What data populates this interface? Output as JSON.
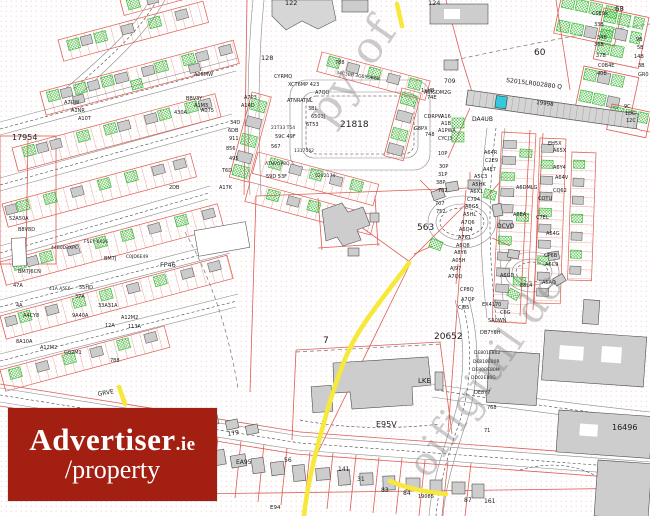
{
  "logo": {
    "brand": "Advertiser",
    "tld": ".ie",
    "line2": "/property",
    "bg_color": "#a31f12",
    "fg_color": "#ffffff"
  },
  "map": {
    "highlight_reference": "S2015LR002880 Q",
    "colors": {
      "parcel_red": "#dd5d52",
      "building_gray": "#cdcdcd",
      "green_hatch": "#2eb82e",
      "route_yellow": "#f6e93c",
      "highlight_cyan": "#35c8dc",
      "stipple_pink": "#f0b8b8"
    },
    "watermarks": [
      {
        "t": "py of",
        "x": 330,
        "y": 128,
        "s": 44,
        "r": -55
      },
      {
        "t": "oifigiúil de",
        "x": 428,
        "y": 480,
        "s": 40,
        "r": -55
      }
    ],
    "labels": [
      {
        "t": "17954",
        "x": 12,
        "y": 140,
        "s": 8
      },
      {
        "t": "21818",
        "x": 340,
        "y": 127,
        "s": 9
      },
      {
        "t": "563",
        "x": 417,
        "y": 230,
        "s": 9
      },
      {
        "t": "7",
        "x": 323,
        "y": 343,
        "s": 9
      },
      {
        "t": "20652",
        "x": 434,
        "y": 339,
        "s": 9
      },
      {
        "t": "E95V",
        "x": 376,
        "y": 427,
        "s": 8
      },
      {
        "t": "60",
        "x": 534,
        "y": 55,
        "s": 9
      },
      {
        "t": "68",
        "x": 615,
        "y": 11,
        "s": 7
      },
      {
        "t": "16496",
        "x": 612,
        "y": 430,
        "s": 8
      },
      {
        "t": "122",
        "x": 285,
        "y": 5,
        "s": 6.5
      },
      {
        "t": "124",
        "x": 428,
        "y": 5,
        "s": 6.5
      },
      {
        "t": "128",
        "x": 261,
        "y": 60,
        "s": 6.5
      },
      {
        "t": "FF46",
        "x": 160,
        "y": 267,
        "s": 6.5
      },
      {
        "t": "LKE",
        "x": 418,
        "y": 383,
        "s": 7
      },
      {
        "t": "GRVE",
        "x": 98,
        "y": 396,
        "s": 6,
        "r": -10
      },
      {
        "t": "DA4UB",
        "x": 472,
        "y": 121,
        "s": 6
      },
      {
        "t": "709",
        "x": 444,
        "y": 83,
        "s": 6
      },
      {
        "t": "A6IGDM2G",
        "x": 424,
        "y": 94,
        "s": 5
      },
      {
        "t": "S2015LR002880 Q",
        "x": 506,
        "y": 82,
        "s": 6,
        "r": 7
      },
      {
        "t": "19998",
        "x": 536,
        "y": 104,
        "s": 5.5,
        "r": 7
      },
      {
        "t": "DCVD",
        "x": 497,
        "y": 228,
        "s": 6
      },
      {
        "t": "0024",
        "x": 204,
        "y": 430,
        "s": 5.5,
        "r": -10
      },
      {
        "t": "179",
        "x": 228,
        "y": 436,
        "s": 6,
        "r": -10
      },
      {
        "t": "EA95",
        "x": 236,
        "y": 464,
        "s": 6
      },
      {
        "t": "56",
        "x": 284,
        "y": 462,
        "s": 6
      },
      {
        "t": "141",
        "x": 338,
        "y": 471,
        "s": 6
      },
      {
        "t": "31",
        "x": 357,
        "y": 481,
        "s": 6
      },
      {
        "t": "83",
        "x": 381,
        "y": 492,
        "s": 6
      },
      {
        "t": "84",
        "x": 403,
        "y": 495,
        "s": 6
      },
      {
        "t": "19085",
        "x": 418,
        "y": 498,
        "s": 5
      },
      {
        "t": "87",
        "x": 464,
        "y": 502,
        "s": 6
      },
      {
        "t": "161",
        "x": 484,
        "y": 503,
        "s": 6
      },
      {
        "t": "E94",
        "x": 270,
        "y": 509,
        "s": 5.5
      },
      {
        "t": "A16",
        "x": 441,
        "y": 118,
        "s": 5
      },
      {
        "t": "A1B",
        "x": 441,
        "y": 125,
        "s": 5
      },
      {
        "t": "A1PWA",
        "x": 438,
        "y": 132,
        "s": 5
      },
      {
        "t": "CYCJ3",
        "x": 438,
        "y": 140,
        "s": 5
      },
      {
        "t": "10P",
        "x": 438,
        "y": 155,
        "s": 5
      },
      {
        "t": "30P",
        "x": 439,
        "y": 168,
        "s": 5
      },
      {
        "t": "31P",
        "x": 438,
        "y": 176,
        "s": 5
      },
      {
        "t": "38P",
        "x": 436,
        "y": 184,
        "s": 5
      },
      {
        "t": "702",
        "x": 438,
        "y": 192,
        "s": 5
      },
      {
        "t": "707",
        "x": 435,
        "y": 205,
        "s": 5
      },
      {
        "t": "752",
        "x": 436,
        "y": 213,
        "s": 5
      },
      {
        "t": "A64R",
        "x": 484,
        "y": 154,
        "s": 5
      },
      {
        "t": "C2E9",
        "x": 485,
        "y": 162,
        "s": 5
      },
      {
        "t": "A4E7",
        "x": 483,
        "y": 171,
        "s": 5
      },
      {
        "t": "A5C3",
        "x": 474,
        "y": 178,
        "s": 5
      },
      {
        "t": "A5HK",
        "x": 472,
        "y": 186,
        "s": 5
      },
      {
        "t": "A6X1",
        "x": 470,
        "y": 193,
        "s": 5
      },
      {
        "t": "C794",
        "x": 467,
        "y": 201,
        "s": 5
      },
      {
        "t": "A6G5",
        "x": 465,
        "y": 208,
        "s": 5
      },
      {
        "t": "A5HL",
        "x": 463,
        "y": 216,
        "s": 5
      },
      {
        "t": "A7Q6",
        "x": 461,
        "y": 224,
        "s": 5
      },
      {
        "t": "A6Q4",
        "x": 459,
        "y": 231,
        "s": 5
      },
      {
        "t": "A761",
        "x": 458,
        "y": 239,
        "s": 5
      },
      {
        "t": "A6Q8",
        "x": 456,
        "y": 247,
        "s": 5
      },
      {
        "t": "A8Y6",
        "x": 454,
        "y": 254,
        "s": 5
      },
      {
        "t": "A05H",
        "x": 452,
        "y": 262,
        "s": 5
      },
      {
        "t": "AJ97",
        "x": 450,
        "y": 270,
        "s": 5
      },
      {
        "t": "A7QQ",
        "x": 448,
        "y": 278,
        "s": 5
      },
      {
        "t": "CP8Q",
        "x": 460,
        "y": 291,
        "s": 5
      },
      {
        "t": "A7QP",
        "x": 461,
        "y": 301,
        "s": 5
      },
      {
        "t": "CJ85",
        "x": 458,
        "y": 309,
        "s": 5
      },
      {
        "t": "EX4170",
        "x": 482,
        "y": 306,
        "s": 5
      },
      {
        "t": "C6G",
        "x": 500,
        "y": 314,
        "s": 5
      },
      {
        "t": "SA0WN",
        "x": 488,
        "y": 322,
        "s": 5
      },
      {
        "t": "DB7Y6H",
        "x": 480,
        "y": 334,
        "s": 5
      },
      {
        "t": "DE801E802",
        "x": 474,
        "y": 354,
        "s": 4.5
      },
      {
        "t": "DE810E80R",
        "x": 473,
        "y": 363,
        "s": 4.5
      },
      {
        "t": "DE80BE80M",
        "x": 472,
        "y": 371,
        "s": 4.5
      },
      {
        "t": "DD02E80G",
        "x": 471,
        "y": 379,
        "s": 4.5
      },
      {
        "t": "DE8Y7",
        "x": 474,
        "y": 394,
        "s": 5
      },
      {
        "t": "768",
        "x": 487,
        "y": 409,
        "s": 5
      },
      {
        "t": "71",
        "x": 484,
        "y": 432,
        "s": 5
      },
      {
        "t": "EH5X",
        "x": 548,
        "y": 145,
        "s": 5
      },
      {
        "t": "A65X",
        "x": 553,
        "y": 152,
        "s": 5
      },
      {
        "t": "A6Y4",
        "x": 553,
        "y": 169,
        "s": 5
      },
      {
        "t": "A64V",
        "x": 555,
        "y": 179,
        "s": 5
      },
      {
        "t": "A6DMLG",
        "x": 516,
        "y": 189,
        "s": 5
      },
      {
        "t": "CQ62",
        "x": 553,
        "y": 192,
        "s": 5
      },
      {
        "t": "CQTU",
        "x": 538,
        "y": 200,
        "s": 5
      },
      {
        "t": "A6EA",
        "x": 513,
        "y": 216,
        "s": 5
      },
      {
        "t": "C7EL",
        "x": 536,
        "y": 219,
        "s": 5
      },
      {
        "t": "A64G",
        "x": 546,
        "y": 235,
        "s": 5
      },
      {
        "t": "CP6B",
        "x": 544,
        "y": 257,
        "s": 5
      },
      {
        "t": "A6C9",
        "x": 545,
        "y": 266,
        "s": 5
      },
      {
        "t": "A6GD",
        "x": 500,
        "y": 277,
        "s": 5
      },
      {
        "t": "E8L4",
        "x": 520,
        "y": 287,
        "s": 5
      },
      {
        "t": "A6AQ",
        "x": 542,
        "y": 284,
        "s": 5
      },
      {
        "t": "C0E9x",
        "x": 592,
        "y": 15,
        "s": 5
      },
      {
        "t": "33B",
        "x": 594,
        "y": 26,
        "s": 5
      },
      {
        "t": "34B",
        "x": 597,
        "y": 39,
        "s": 5
      },
      {
        "t": "36B",
        "x": 594,
        "y": 46,
        "s": 5
      },
      {
        "t": "37B",
        "x": 596,
        "y": 57,
        "s": 5
      },
      {
        "t": "C0B4E",
        "x": 598,
        "y": 67,
        "s": 5
      },
      {
        "t": "40B",
        "x": 597,
        "y": 75,
        "s": 5
      },
      {
        "t": "9B",
        "x": 636,
        "y": 41,
        "s": 5
      },
      {
        "t": "5B",
        "x": 637,
        "y": 49,
        "s": 5
      },
      {
        "t": "14B",
        "x": 634,
        "y": 58,
        "s": 5
      },
      {
        "t": "3B",
        "x": 638,
        "y": 67,
        "s": 5
      },
      {
        "t": "GR0",
        "x": 638,
        "y": 76,
        "s": 5
      },
      {
        "t": "9C",
        "x": 624,
        "y": 108,
        "s": 5
      },
      {
        "t": "1DC",
        "x": 625,
        "y": 115,
        "s": 5
      },
      {
        "t": "12C",
        "x": 626,
        "y": 122,
        "s": 5
      },
      {
        "t": "CYRMQ",
        "x": 274,
        "y": 78,
        "s": 5
      },
      {
        "t": "XCT6MP 423",
        "x": 288,
        "y": 86,
        "s": 5
      },
      {
        "t": "A7QQ",
        "x": 315,
        "y": 94,
        "s": 5
      },
      {
        "t": "ATNRATNL",
        "x": 287,
        "y": 102,
        "s": 5
      },
      {
        "t": "3BL",
        "x": 308,
        "y": 110,
        "s": 5
      },
      {
        "t": "6503J",
        "x": 311,
        "y": 118,
        "s": 5
      },
      {
        "t": "6T53",
        "x": 306,
        "y": 126,
        "s": 5
      },
      {
        "t": "788",
        "x": 335,
        "y": 64,
        "s": 5
      },
      {
        "t": "34C3BB 3G05DBBB",
        "x": 336,
        "y": 74,
        "s": 4.5,
        "r": 8
      },
      {
        "t": "1aHB",
        "x": 421,
        "y": 92,
        "s": 5
      },
      {
        "t": "74E",
        "x": 427,
        "y": 99,
        "s": 5
      },
      {
        "t": "CDRPW",
        "x": 424,
        "y": 118,
        "s": 5
      },
      {
        "t": "G8PX",
        "x": 414,
        "y": 130,
        "s": 5
      },
      {
        "t": "748",
        "x": 425,
        "y": 136,
        "s": 5
      },
      {
        "t": "21T33 T54",
        "x": 271,
        "y": 129,
        "s": 4.5
      },
      {
        "t": "59C 49F",
        "x": 275,
        "y": 138,
        "s": 5
      },
      {
        "t": "567",
        "x": 271,
        "y": 148,
        "s": 5
      },
      {
        "t": "1317562",
        "x": 294,
        "y": 152,
        "s": 4.5
      },
      {
        "t": "ATNVQP8Q",
        "x": 265,
        "y": 165,
        "s": 4.5
      },
      {
        "t": "59D 53F",
        "x": 266,
        "y": 178,
        "s": 5
      },
      {
        "t": "52V2174",
        "x": 315,
        "y": 177,
        "s": 4.5
      },
      {
        "t": "A05MW",
        "x": 194,
        "y": 76,
        "s": 5
      },
      {
        "t": "BBV3Y",
        "x": 186,
        "y": 100,
        "s": 5
      },
      {
        "t": "A1M3",
        "x": 194,
        "y": 107,
        "s": 5
      },
      {
        "t": "430A",
        "x": 174,
        "y": 114,
        "s": 5
      },
      {
        "t": "A075",
        "x": 201,
        "y": 112,
        "s": 5
      },
      {
        "t": "A7QW",
        "x": 64,
        "y": 104,
        "s": 5
      },
      {
        "t": "A1NR",
        "x": 71,
        "y": 112,
        "s": 5
      },
      {
        "t": "A10T",
        "x": 78,
        "y": 120,
        "s": 5
      },
      {
        "t": "A7P3",
        "x": 244,
        "y": 99,
        "s": 5
      },
      {
        "t": "A14D",
        "x": 241,
        "y": 107,
        "s": 5
      },
      {
        "t": "34D",
        "x": 230,
        "y": 124,
        "s": 5
      },
      {
        "t": "6DB",
        "x": 228,
        "y": 132,
        "s": 5
      },
      {
        "t": "911",
        "x": 229,
        "y": 140,
        "s": 5
      },
      {
        "t": "856",
        "x": 226,
        "y": 150,
        "s": 5
      },
      {
        "t": "495",
        "x": 229,
        "y": 160,
        "s": 5
      },
      {
        "t": "T6D",
        "x": 222,
        "y": 172,
        "s": 5
      },
      {
        "t": "A17K",
        "x": 219,
        "y": 189,
        "s": 5
      },
      {
        "t": "2DB",
        "x": 169,
        "y": 189,
        "s": 5
      },
      {
        "t": "52A50A",
        "x": 9,
        "y": 220,
        "s": 5
      },
      {
        "t": "B8V8D",
        "x": 18,
        "y": 231,
        "s": 5
      },
      {
        "t": "F5EY 6X26",
        "x": 84,
        "y": 243,
        "s": 4.5
      },
      {
        "t": "44B0D3XPC",
        "x": 51,
        "y": 249,
        "s": 4.5
      },
      {
        "t": "BM7J6CN",
        "x": 18,
        "y": 273,
        "s": 5
      },
      {
        "t": "BM7J",
        "x": 104,
        "y": 260,
        "s": 5
      },
      {
        "t": "C0JD6E49",
        "x": 126,
        "y": 258,
        "s": 4.5
      },
      {
        "t": "47A",
        "x": 13,
        "y": 287,
        "s": 5
      },
      {
        "t": "4A",
        "x": 16,
        "y": 307,
        "s": 5
      },
      {
        "t": "A4CY8",
        "x": 23,
        "y": 317,
        "s": 5
      },
      {
        "t": "41A A5F6",
        "x": 49,
        "y": 290,
        "s": 4.5
      },
      {
        "t": "55HD",
        "x": 79,
        "y": 289,
        "s": 5
      },
      {
        "t": "37A",
        "x": 75,
        "y": 298,
        "s": 5
      },
      {
        "t": "33A31A",
        "x": 98,
        "y": 307,
        "s": 5
      },
      {
        "t": "9A40A",
        "x": 72,
        "y": 317,
        "s": 5
      },
      {
        "t": "A12M2",
        "x": 121,
        "y": 319,
        "s": 5
      },
      {
        "t": "12A",
        "x": 105,
        "y": 327,
        "s": 5
      },
      {
        "t": "113A",
        "x": 128,
        "y": 328,
        "s": 5
      },
      {
        "t": "8A10A",
        "x": 16,
        "y": 343,
        "s": 5
      },
      {
        "t": "A12M2",
        "x": 40,
        "y": 349,
        "s": 5
      },
      {
        "t": "G02M1",
        "x": 64,
        "y": 354,
        "s": 5
      },
      {
        "t": "788",
        "x": 110,
        "y": 362,
        "s": 5
      }
    ]
  }
}
